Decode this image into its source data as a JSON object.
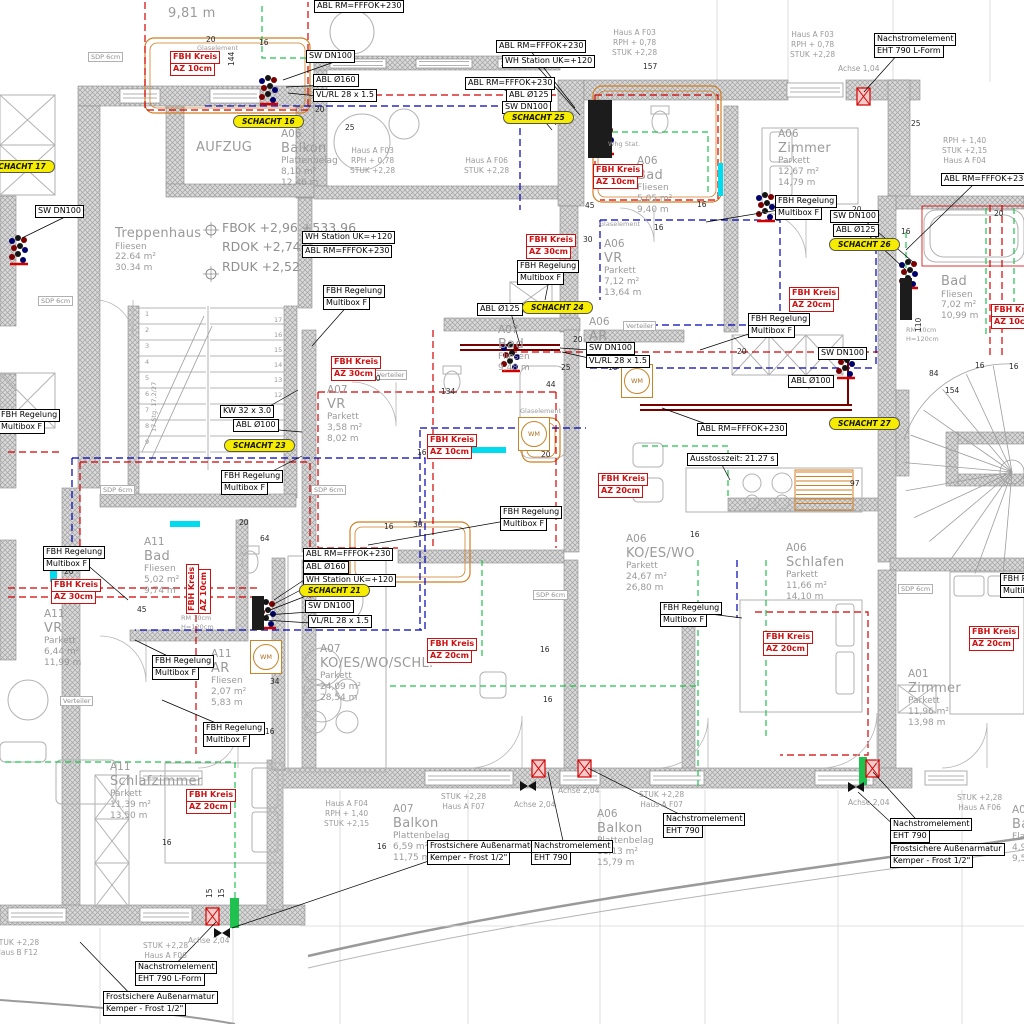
{
  "colors": {
    "pipe_red": "#d40000",
    "pipe_blue": "#0000b0",
    "pipe_green": "#1fc24e",
    "pipe_cyan": "#00dcee",
    "wall_fill": "#d6d6d6",
    "wall_hatch": "#a2a2a2",
    "schacht_yellow": "#f5ec00",
    "fbh_red": "#cc1111",
    "label_gray": "#9a9a9a",
    "furniture_orange": "#cf7f22"
  },
  "levels": {
    "x": 222,
    "y": 218,
    "lines": [
      "FBOK +2,96 +533,96",
      "RDOK +2,74",
      "RDUK +2,52"
    ]
  },
  "rooms": [
    {
      "x": 115,
      "y": 226,
      "big": 0,
      "lines": [
        "Treppenhaus",
        "Fliesen",
        "22.64 m²",
        "30.34 m"
      ]
    },
    {
      "x": 196,
      "y": 140,
      "big": 0,
      "lines": [
        "AUFZUG"
      ]
    },
    {
      "x": 281,
      "y": 128,
      "big": 1,
      "lines": [
        "A06",
        "Balkon",
        "Plattenbelag",
        "8,10 m²",
        "12,46 m"
      ]
    },
    {
      "x": 778,
      "y": 128,
      "big": 1,
      "lines": [
        "A06",
        "Zimmer",
        "Parkett",
        "12,67 m²",
        "14,79 m"
      ]
    },
    {
      "x": 637,
      "y": 155,
      "big": 1,
      "lines": [
        "A06",
        "Bad",
        "Fliesen",
        "5,05 m²",
        "9,40 m"
      ]
    },
    {
      "x": 604,
      "y": 238,
      "big": 1,
      "lines": [
        "A06",
        "VR",
        "Parkett",
        "7,12 m²",
        "13,64 m"
      ]
    },
    {
      "x": 589,
      "y": 316,
      "big": 1,
      "lines": [
        "A06",
        "AR"
      ]
    },
    {
      "x": 941,
      "y": 274,
      "big": 0,
      "lines": [
        "Bad",
        "Fliesen",
        "7,02 m²",
        "10,99 m"
      ]
    },
    {
      "x": 327,
      "y": 384,
      "big": 1,
      "lines": [
        "A07",
        "VR",
        "Parkett",
        "3,58 m²",
        "8,02 m"
      ]
    },
    {
      "x": 498,
      "y": 324,
      "big": 1,
      "lines": [
        "A07",
        "Bad",
        "Fliesen",
        "9,48 m"
      ]
    },
    {
      "x": 144,
      "y": 536,
      "big": 1,
      "lines": [
        "A11",
        "Bad",
        "Fliesen",
        "5,02 m²",
        "9,74 m"
      ]
    },
    {
      "x": 44,
      "y": 608,
      "big": 1,
      "lines": [
        "A11",
        "VR",
        "Parkett",
        "6,44 m²",
        "11,99 m"
      ]
    },
    {
      "x": 211,
      "y": 648,
      "big": 1,
      "lines": [
        "A11",
        "AR",
        "Fliesen",
        "2,07 m²",
        "5,83 m"
      ]
    },
    {
      "x": 110,
      "y": 761,
      "big": 1,
      "lines": [
        "A11",
        "Schlafzimmer",
        "Parkett",
        "11,39 m²",
        "13,50 m"
      ]
    },
    {
      "x": 320,
      "y": 643,
      "big": 1,
      "lines": [
        "A07",
        "KO/ES/WO/SCHL.",
        "Parkett",
        "24,09 m²",
        "28,54 m"
      ]
    },
    {
      "x": 626,
      "y": 533,
      "big": 1,
      "lines": [
        "A06",
        "KO/ES/WO",
        "Parkett",
        "24,67 m²",
        "26,80 m"
      ]
    },
    {
      "x": 786,
      "y": 542,
      "big": 1,
      "lines": [
        "A06",
        "Schlafen",
        "Parkett",
        "11,66 m²",
        "14,10 m"
      ]
    },
    {
      "x": 908,
      "y": 668,
      "big": 1,
      "lines": [
        "A01",
        "Zimmer",
        "Parkett",
        "11,96 m²",
        "13,98 m"
      ]
    },
    {
      "x": 393,
      "y": 803,
      "big": 1,
      "lines": [
        "A07",
        "Balkon",
        "Plattenbelag",
        "6,59 m²",
        "11,75 m"
      ]
    },
    {
      "x": 597,
      "y": 808,
      "big": 1,
      "lines": [
        "A06",
        "Balkon",
        "Plattenbelag",
        "11,13 m²",
        "15,79 m"
      ]
    },
    {
      "x": 1012,
      "y": 804,
      "big": 1,
      "lines": [
        "A0",
        "Ba",
        "Fla",
        "4,9",
        "9,5"
      ]
    },
    {
      "x": 168,
      "y": 6,
      "big": 0,
      "lines": [
        "9,81 m"
      ]
    }
  ],
  "site": [
    {
      "x": 612,
      "y": 28,
      "lines": [
        "Haus A F03",
        "RPH + 0,78",
        "STUK +2,28"
      ]
    },
    {
      "x": 790,
      "y": 30,
      "lines": [
        "Haus A F03",
        "RPH + 0,78",
        "STUK +2,28"
      ]
    },
    {
      "x": 350,
      "y": 146,
      "lines": [
        "Haus A F03",
        "RPH + 0,78",
        "STUK +2,28"
      ]
    },
    {
      "x": 464,
      "y": 156,
      "lines": [
        "Haus A F06",
        "STUK +2,28"
      ]
    },
    {
      "x": 942,
      "y": 136,
      "lines": [
        "RPH + 1,40",
        "STUK +2,15",
        "Haus A F04"
      ]
    },
    {
      "x": 838,
      "y": 64,
      "lines": [
        "Achse 1,04"
      ]
    },
    {
      "x": 441,
      "y": 792,
      "lines": [
        "STUK +2,28",
        "Haus A F07"
      ]
    },
    {
      "x": 639,
      "y": 790,
      "lines": [
        "STUK +2,28",
        "Haus A F07"
      ]
    },
    {
      "x": 957,
      "y": 793,
      "lines": [
        "STUK +2,28",
        "Haus A F06"
      ]
    },
    {
      "x": 143,
      "y": 941,
      "lines": [
        "STUK +2,28",
        "Haus A F06"
      ]
    },
    {
      "x": -6,
      "y": 938,
      "lines": [
        "STUK +2,28",
        "Haus B F12"
      ]
    },
    {
      "x": 514,
      "y": 800,
      "lines": [
        "Achse 2,04"
      ]
    },
    {
      "x": 558,
      "y": 786,
      "lines": [
        "Achse 2,04"
      ]
    },
    {
      "x": 848,
      "y": 798,
      "lines": [
        "Achse 2,04"
      ]
    },
    {
      "x": 188,
      "y": 936,
      "lines": [
        "Achse 2,04"
      ]
    },
    {
      "x": 324,
      "y": 799,
      "lines": [
        "Haus A F04",
        "RPH + 1,40",
        "STUK +2,15"
      ]
    }
  ],
  "callouts": [
    {
      "x": 496,
      "y": 41,
      "lines": [
        "ABL RM=FFFOK+230"
      ],
      "tx": 575,
      "ty": 108
    },
    {
      "x": 502,
      "y": 56,
      "lines": [
        "WH Station UK=+120"
      ],
      "tx": 580,
      "ty": 115
    },
    {
      "x": 465,
      "y": 78,
      "lines": [
        "ABL RM=FFFOK+230"
      ],
      "tx": 562,
      "ty": 120
    },
    {
      "x": 506,
      "y": 90,
      "lines": [
        "ABL Ø125"
      ],
      "tx": 556,
      "ty": 125
    },
    {
      "x": 502,
      "y": 102,
      "lines": [
        "SW DN100"
      ],
      "tx": 552,
      "ty": 130
    },
    {
      "x": 306,
      "y": 51,
      "lines": [
        "SW DN100"
      ],
      "tx": 283,
      "ty": 80
    },
    {
      "x": 313,
      "y": 75,
      "lines": [
        "ABL Ø160"
      ],
      "tx": 286,
      "ty": 87
    },
    {
      "x": 313,
      "y": 90,
      "lines": [
        "VL/RL 28 x 1.5"
      ],
      "tx": 288,
      "ty": 93
    },
    {
      "x": 314,
      "y": 1,
      "lines": [
        "ABL RM=FFFOK+230"
      ]
    },
    {
      "x": 35,
      "y": 206,
      "lines": [
        "SW DN100"
      ],
      "tx": 22,
      "ty": 238
    },
    {
      "x": 941,
      "y": 174,
      "lines": [
        "ABL RM=FFFOK+230"
      ],
      "tx": 906,
      "ty": 250
    },
    {
      "x": 874,
      "y": 34,
      "lines": [
        "Nachstromelement",
        "EHT 790 L-Form"
      ],
      "tx": 864,
      "ty": 92
    },
    {
      "x": 830,
      "y": 211,
      "lines": [
        "SW DN100"
      ],
      "tx": 913,
      "ty": 262
    },
    {
      "x": 833,
      "y": 225,
      "lines": [
        "ABL Ø125"
      ],
      "tx": 906,
      "ty": 270
    },
    {
      "x": 775,
      "y": 196,
      "lines": [
        "FBH Regelung",
        "Multibox F"
      ],
      "tx": 706,
      "ty": 222
    },
    {
      "x": 302,
      "y": 232,
      "lines": [
        "WH Station UK=+120"
      ]
    },
    {
      "x": 302,
      "y": 246,
      "lines": [
        "ABL RM=FFFOK+230"
      ]
    },
    {
      "x": 323,
      "y": 286,
      "lines": [
        "FBH Regelung",
        "Multibox F"
      ],
      "tx": 312,
      "ty": 346
    },
    {
      "x": 517,
      "y": 261,
      "lines": [
        "FBH Regelung",
        "Multibox F"
      ],
      "tx": 545,
      "ty": 300
    },
    {
      "x": 586,
      "y": 343,
      "lines": [
        "SW DN100"
      ],
      "tx": 560,
      "ty": 348
    },
    {
      "x": 586,
      "y": 356,
      "lines": [
        "VL/RL 28 x 1.5"
      ],
      "tx": 562,
      "ty": 352
    },
    {
      "x": 477,
      "y": 304,
      "lines": [
        "ABL Ø125"
      ],
      "tx": 520,
      "ty": 345
    },
    {
      "x": 748,
      "y": 314,
      "lines": [
        "FBH Regelung",
        "Multibox F"
      ],
      "tx": 700,
      "ty": 350
    },
    {
      "x": 220,
      "y": 406,
      "lines": [
        "KW 32 x 3.0"
      ],
      "tx": 298,
      "ty": 390
    },
    {
      "x": 233,
      "y": 420,
      "lines": [
        "ABL Ø100"
      ],
      "tx": 302,
      "ty": 432
    },
    {
      "x": 221,
      "y": 471,
      "lines": [
        "FBH Regelung",
        "Multibox F"
      ],
      "tx": 302,
      "ty": 456
    },
    {
      "x": -2,
      "y": 410,
      "lines": [
        "FBH Regelung",
        "Multibox F"
      ]
    },
    {
      "x": 697,
      "y": 424,
      "lines": [
        "ABL RM=FFFOK+230"
      ],
      "tx": 662,
      "ty": 408
    },
    {
      "x": 788,
      "y": 376,
      "lines": [
        "ABL Ø100"
      ],
      "tx": 808,
      "ty": 388
    },
    {
      "x": 818,
      "y": 348,
      "lines": [
        "SW DN100"
      ],
      "tx": 850,
      "ty": 356
    },
    {
      "x": 687,
      "y": 454,
      "lines": [
        "Ausstosszeit: 21.27 s"
      ],
      "tx": 730,
      "ty": 480
    },
    {
      "x": 500,
      "y": 507,
      "lines": [
        "FBH Regelung",
        "Multibox F"
      ],
      "tx": 368,
      "ty": 545
    },
    {
      "x": 43,
      "y": 547,
      "lines": [
        "FBH Regelung",
        "Multibox F"
      ],
      "tx": 128,
      "ty": 600
    },
    {
      "x": 152,
      "y": 656,
      "lines": [
        "FBH Regelung",
        "Multibox F"
      ],
      "tx": 135,
      "ty": 640
    },
    {
      "x": 203,
      "y": 723,
      "lines": [
        "FBH Regelung",
        "Multibox F"
      ],
      "tx": 162,
      "ty": 700
    },
    {
      "x": 303,
      "y": 549,
      "lines": [
        "ABL RM=FFFOK+230"
      ],
      "tx": 274,
      "ty": 600
    },
    {
      "x": 303,
      "y": 562,
      "lines": [
        "ABL Ø160"
      ],
      "tx": 272,
      "ty": 605
    },
    {
      "x": 303,
      "y": 575,
      "lines": [
        "WH Station UK=+120"
      ],
      "tx": 270,
      "ty": 610
    },
    {
      "x": 305,
      "y": 601,
      "lines": [
        "SW DN100"
      ],
      "tx": 266,
      "ty": 615
    },
    {
      "x": 308,
      "y": 616,
      "lines": [
        "VL/RL 28 x 1.5"
      ],
      "tx": 264,
      "ty": 620
    },
    {
      "x": 660,
      "y": 603,
      "lines": [
        "FBH Regelung",
        "Multibox F"
      ],
      "tx": 742,
      "ty": 618
    },
    {
      "x": 1000,
      "y": 574,
      "lines": [
        "FBH Regelung",
        "Multibox F"
      ]
    },
    {
      "x": 427,
      "y": 841,
      "lines": [
        "Frostsichere Außenarmatur",
        "Kemper - Frost 1/2\""
      ],
      "tx": 232,
      "ty": 928
    },
    {
      "x": 531,
      "y": 841,
      "lines": [
        "Nachstromelement",
        "EHT 790"
      ],
      "tx": 548,
      "ty": 772
    },
    {
      "x": 663,
      "y": 814,
      "lines": [
        "Nachstromelement",
        "EHT 790"
      ],
      "tx": 588,
      "ty": 768
    },
    {
      "x": 890,
      "y": 819,
      "lines": [
        "Nachstromelement",
        "EHT 790"
      ],
      "tx": 873,
      "ty": 772
    },
    {
      "x": 890,
      "y": 844,
      "lines": [
        "Frostsichere Außenarmatur",
        "Kemper - Frost 1/2\""
      ],
      "tx": 858,
      "ty": 792
    },
    {
      "x": 135,
      "y": 962,
      "lines": [
        "Nachstromelement",
        "EHT 790 L-Form"
      ],
      "tx": 216,
      "ty": 922
    },
    {
      "x": 103,
      "y": 992,
      "lines": [
        "Frostsichere Außenarmatur",
        "Kemper - Frost 1/2\""
      ],
      "tx": 80,
      "ty": 942
    }
  ],
  "schacht": [
    {
      "x": 233,
      "y": 115,
      "t": "SCHACHT 16"
    },
    {
      "x": -16,
      "y": 160,
      "t": "SCHACHT 17"
    },
    {
      "x": 503,
      "y": 111,
      "t": "SCHACHT 25"
    },
    {
      "x": 829,
      "y": 238,
      "t": "SCHACHT 26"
    },
    {
      "x": 522,
      "y": 301,
      "t": "SCHACHT 24"
    },
    {
      "x": 224,
      "y": 439,
      "t": "SCHACHT 23"
    },
    {
      "x": 829,
      "y": 417,
      "t": "SCHACHT 27"
    },
    {
      "x": 299,
      "y": 584,
      "t": "SCHACHT 21"
    }
  ],
  "fbh": [
    {
      "x": 170,
      "y": 52,
      "lines": [
        "FBH Kreis",
        "AZ 10cm"
      ]
    },
    {
      "x": 593,
      "y": 165,
      "lines": [
        "FBH Kreis",
        "AZ 10cm"
      ]
    },
    {
      "x": 526,
      "y": 235,
      "lines": [
        "FBH Kreis",
        "AZ 30cm"
      ]
    },
    {
      "x": 331,
      "y": 357,
      "lines": [
        "FBH Kreis",
        "AZ 30cm"
      ]
    },
    {
      "x": 427,
      "y": 435,
      "lines": [
        "FBH Kreis",
        "AZ 10cm"
      ]
    },
    {
      "x": 598,
      "y": 474,
      "lines": [
        "FBH Kreis",
        "AZ 20cm"
      ]
    },
    {
      "x": 789,
      "y": 288,
      "lines": [
        "FBH Kreis",
        "AZ 20cm"
      ]
    },
    {
      "x": 991,
      "y": 305,
      "lines": [
        "FBH Kreis",
        "AZ 10cm"
      ]
    },
    {
      "x": 51,
      "y": 580,
      "lines": [
        "FBH Kreis",
        "AZ 30cm"
      ]
    },
    {
      "x": 187,
      "y": 614,
      "rot": 1,
      "lines": [
        "FBH Kreis",
        "AZ 10cm"
      ]
    },
    {
      "x": 186,
      "y": 790,
      "lines": [
        "FBH Kreis",
        "AZ 20cm"
      ]
    },
    {
      "x": 427,
      "y": 639,
      "lines": [
        "FBH Kreis",
        "AZ 20cm"
      ]
    },
    {
      "x": 763,
      "y": 632,
      "lines": [
        "FBH Kreis",
        "AZ 20cm"
      ]
    },
    {
      "x": 969,
      "y": 627,
      "lines": [
        "FBH Kreis",
        "AZ 20cm"
      ]
    }
  ],
  "sdp": [
    {
      "x": 88,
      "y": 52,
      "t": "SDP 6cm"
    },
    {
      "x": 38,
      "y": 296,
      "t": "SDP 6cm"
    },
    {
      "x": 100,
      "y": 485,
      "t": "SDP 6cm"
    },
    {
      "x": 311,
      "y": 485,
      "t": "SDP 6cm"
    },
    {
      "x": 533,
      "y": 590,
      "t": "SDP 6cm"
    },
    {
      "x": 898,
      "y": 584,
      "t": "SDP 6cm"
    }
  ],
  "verteiler": [
    {
      "x": 623,
      "y": 321,
      "t": "Verteiler"
    },
    {
      "x": 374,
      "y": 370,
      "t": "Verteiler"
    },
    {
      "x": 60,
      "y": 696,
      "t": "Verteiler"
    }
  ],
  "tiny": [
    {
      "x": 197,
      "y": 44,
      "t": "Glaselement"
    },
    {
      "x": 599,
      "y": 220,
      "t": "Glaselement"
    },
    {
      "x": 520,
      "y": 407,
      "t": "Glaselement"
    },
    {
      "x": 608,
      "y": 140,
      "t": "Whg Stat."
    },
    {
      "x": 906,
      "y": 326,
      "t": "RM 10cm"
    },
    {
      "x": 906,
      "y": 335,
      "t": "H=120cm"
    },
    {
      "x": 181,
      "y": 614,
      "t": "RM 10cm"
    },
    {
      "x": 181,
      "y": 623,
      "t": "H=120cm"
    },
    {
      "x": 150,
      "y": 432,
      "t": "17 Stg. 17,2/27",
      "rot": 1
    }
  ],
  "dims": [
    {
      "t": "144",
      "x": 227,
      "y": 66,
      "v": 1
    },
    {
      "t": "157",
      "x": 643,
      "y": 62
    },
    {
      "t": "134",
      "x": 441,
      "y": 387
    },
    {
      "t": "50",
      "x": 371,
      "y": 374
    },
    {
      "t": "44",
      "x": 546,
      "y": 380
    },
    {
      "t": "45",
      "x": 585,
      "y": 201
    },
    {
      "t": "45",
      "x": 137,
      "y": 605
    },
    {
      "t": "64",
      "x": 260,
      "y": 534
    },
    {
      "t": "84",
      "x": 929,
      "y": 369
    },
    {
      "t": "154",
      "x": 945,
      "y": 386
    },
    {
      "t": "97",
      "x": 850,
      "y": 479
    },
    {
      "t": "110",
      "x": 914,
      "y": 332,
      "v": 1
    },
    {
      "t": "34",
      "x": 270,
      "y": 677
    },
    {
      "t": "15",
      "x": 205,
      "y": 898,
      "v": 1
    },
    {
      "t": "15",
      "x": 217,
      "y": 898,
      "v": 1
    },
    {
      "t": "16",
      "x": 259,
      "y": 38
    },
    {
      "t": "16",
      "x": 654,
      "y": 223
    },
    {
      "t": "16",
      "x": 697,
      "y": 200
    },
    {
      "t": "16",
      "x": 608,
      "y": 363
    },
    {
      "t": "16",
      "x": 417,
      "y": 448
    },
    {
      "t": "16",
      "x": 384,
      "y": 522
    },
    {
      "t": "16",
      "x": 265,
      "y": 727
    },
    {
      "t": "16",
      "x": 540,
      "y": 645
    },
    {
      "t": "16",
      "x": 543,
      "y": 695
    },
    {
      "t": "16",
      "x": 377,
      "y": 842
    },
    {
      "t": "16",
      "x": 901,
      "y": 227
    },
    {
      "t": "16",
      "x": 975,
      "y": 361
    },
    {
      "t": "16",
      "x": 690,
      "y": 530
    },
    {
      "t": "16",
      "x": 341,
      "y": 550
    },
    {
      "t": "16",
      "x": 1009,
      "y": 362
    },
    {
      "t": "16",
      "x": 162,
      "y": 838
    },
    {
      "t": "20",
      "x": 206,
      "y": 35
    },
    {
      "t": "20",
      "x": 315,
      "y": 105
    },
    {
      "t": "20",
      "x": 573,
      "y": 335
    },
    {
      "t": "20",
      "x": 541,
      "y": 450
    },
    {
      "t": "20",
      "x": 239,
      "y": 518
    },
    {
      "t": "20",
      "x": 64,
      "y": 567
    },
    {
      "t": "20",
      "x": 852,
      "y": 205
    },
    {
      "t": "20",
      "x": 737,
      "y": 347
    },
    {
      "t": "20",
      "x": 994,
      "y": 209
    },
    {
      "t": "25",
      "x": 345,
      "y": 123
    },
    {
      "t": "25",
      "x": 561,
      "y": 363
    },
    {
      "t": "25",
      "x": 911,
      "y": 119
    },
    {
      "t": "30",
      "x": 204,
      "y": 67
    },
    {
      "t": "30",
      "x": 413,
      "y": 520
    },
    {
      "t": "30",
      "x": 583,
      "y": 235
    }
  ],
  "stair_numbers": {
    "left": [
      "1",
      "2",
      "3",
      "4",
      "5",
      "6",
      "7",
      "8",
      "9"
    ],
    "right": [
      "17",
      "16",
      "15",
      "14",
      "13",
      "12"
    ]
  },
  "wm_label": "WM",
  "wm_positions": [
    {
      "x": 518,
      "y": 417
    },
    {
      "x": 621,
      "y": 364
    },
    {
      "x": 250,
      "y": 640
    }
  ]
}
